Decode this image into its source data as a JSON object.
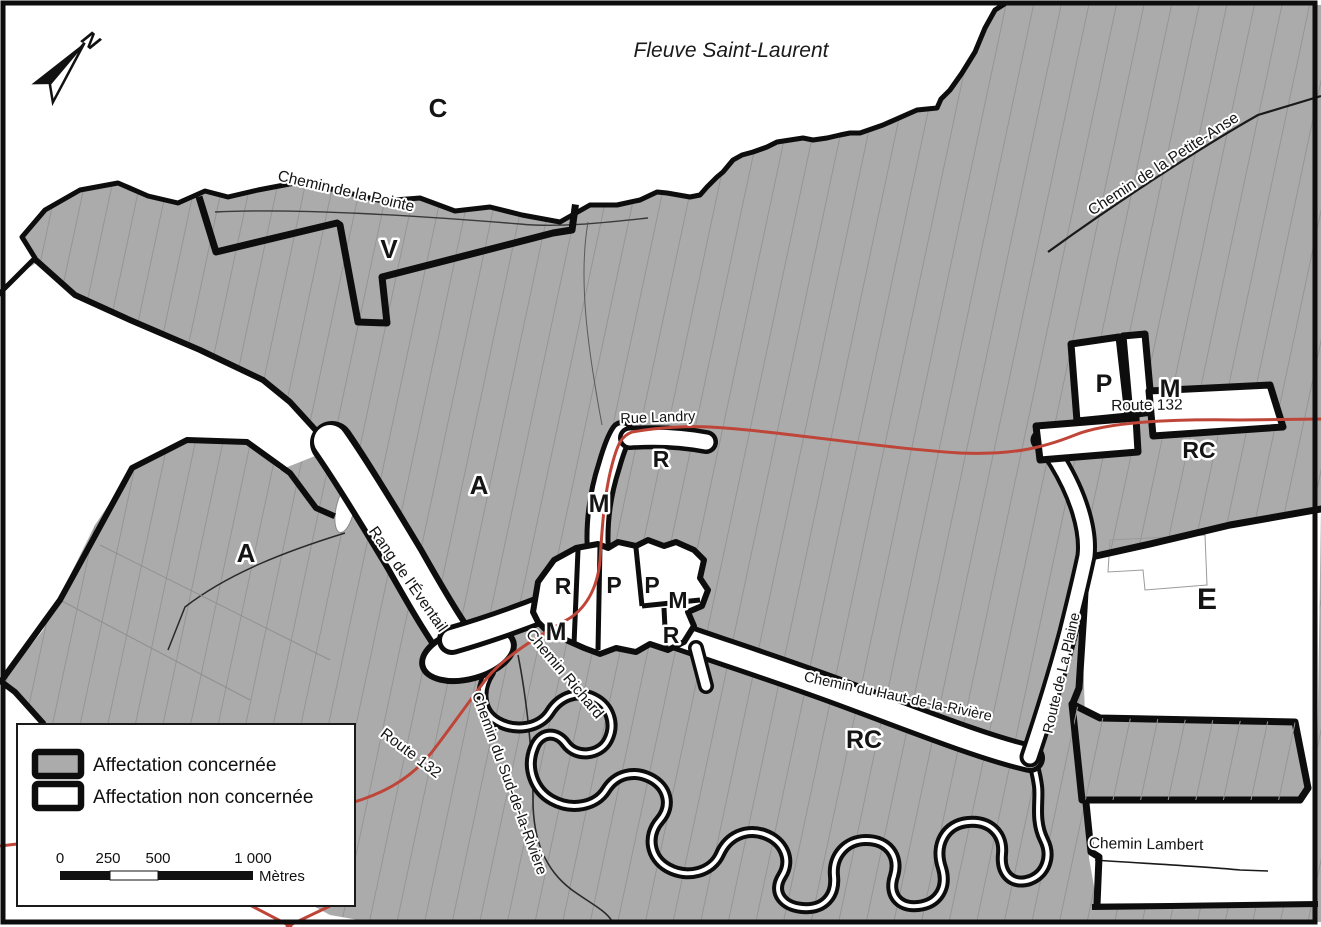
{
  "map": {
    "title": "Fleuve Saint-Laurent",
    "north_arrow": "N",
    "zone_labels": [
      {
        "text": "C"
      },
      {
        "text": "V"
      },
      {
        "text": "A"
      },
      {
        "text": "A"
      },
      {
        "text": "E"
      },
      {
        "text": "R"
      },
      {
        "text": "M"
      },
      {
        "text": "R"
      },
      {
        "text": "P"
      },
      {
        "text": "P"
      },
      {
        "text": "M"
      },
      {
        "text": "R"
      },
      {
        "text": "M"
      },
      {
        "text": "RC"
      },
      {
        "text": "P"
      },
      {
        "text": "M"
      },
      {
        "text": "RC"
      }
    ],
    "road_labels": [
      {
        "text": "Chemin de la Pointe"
      },
      {
        "text": "Chemin de la Petite-Anse"
      },
      {
        "text": "Rue Landry"
      },
      {
        "text": "Route 132"
      },
      {
        "text": "Rang de l'Éventail"
      },
      {
        "text": "Chemin Richard"
      },
      {
        "text": "Chemin du Haut-de-la-Rivière"
      },
      {
        "text": "Route de La Plaine"
      },
      {
        "text": "Chemin du Sud-de-la-Rivière"
      },
      {
        "text": "Route 132"
      },
      {
        "text": "Chemin Lambert"
      }
    ],
    "legend": {
      "items": [
        {
          "label": "Affectation concernée",
          "fill": "#ababab"
        },
        {
          "label": "Affectation non concernée",
          "fill": "#ffffff"
        }
      ]
    },
    "scale_bar": {
      "ticks": [
        "0",
        "250",
        "500",
        "1 000"
      ],
      "unit": "Mètres"
    }
  },
  "colors": {
    "land": "#ababab",
    "water": "#ffffff",
    "boundary": "#0d0d0d",
    "route132": "#bf4538",
    "parcel_line": "#8f8f8f"
  }
}
